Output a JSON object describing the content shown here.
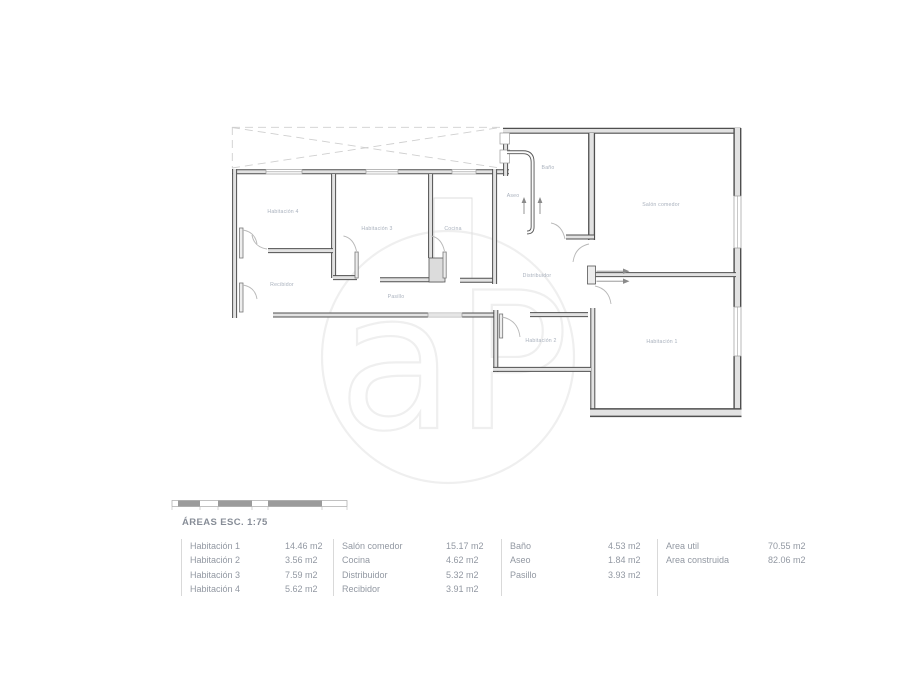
{
  "plan": {
    "watermark": "aP",
    "rooms": [
      {
        "name": "habitacion-4",
        "label": "Habitación 4",
        "x": 283,
        "y": 213
      },
      {
        "name": "habitacion-3",
        "label": "Habitación 3",
        "x": 377,
        "y": 230
      },
      {
        "name": "cocina",
        "label": "Cocina",
        "x": 453,
        "y": 230
      },
      {
        "name": "bano",
        "label": "Baño",
        "x": 548,
        "y": 169
      },
      {
        "name": "aseo",
        "label": "Aseo",
        "x": 513,
        "y": 197
      },
      {
        "name": "salon-comedor",
        "label": "Salón comedor",
        "x": 661,
        "y": 206
      },
      {
        "name": "recibidor",
        "label": "Recibidor",
        "x": 282,
        "y": 286
      },
      {
        "name": "pasillo",
        "label": "Pasillo",
        "x": 396,
        "y": 298
      },
      {
        "name": "distribuidor",
        "label": "Distribuidor",
        "x": 537,
        "y": 277
      },
      {
        "name": "habitacion-2",
        "label": "Habitación 2",
        "x": 541,
        "y": 342
      },
      {
        "name": "habitacion-1",
        "label": "Habitación 1",
        "x": 662,
        "y": 343
      }
    ]
  },
  "legend": {
    "title": "ÁREAS ESC. 1:75",
    "groups": [
      {
        "items": [
          [
            "Habitación 1",
            "14.46 m2"
          ],
          [
            "Habitación 2",
            "3.56 m2"
          ],
          [
            "Habitación 3",
            "7.59 m2"
          ],
          [
            "Habitación 4",
            "5.62 m2"
          ]
        ]
      },
      {
        "items": [
          [
            "Salón comedor",
            "15.17 m2"
          ],
          [
            "Cocina",
            "4.62 m2"
          ],
          [
            "Distribuidor",
            "5.32 m2"
          ],
          [
            "Recibidor",
            "3.91 m2"
          ]
        ]
      },
      {
        "items": [
          [
            "Baño",
            "4.53 m2"
          ],
          [
            "Aseo",
            "1.84 m2"
          ],
          [
            "Pasillo",
            "3.93 m2"
          ]
        ]
      },
      {
        "items": [
          [
            "Area util",
            "70.55 m2"
          ],
          [
            "Area construida",
            "82.06 m2"
          ]
        ]
      }
    ]
  }
}
